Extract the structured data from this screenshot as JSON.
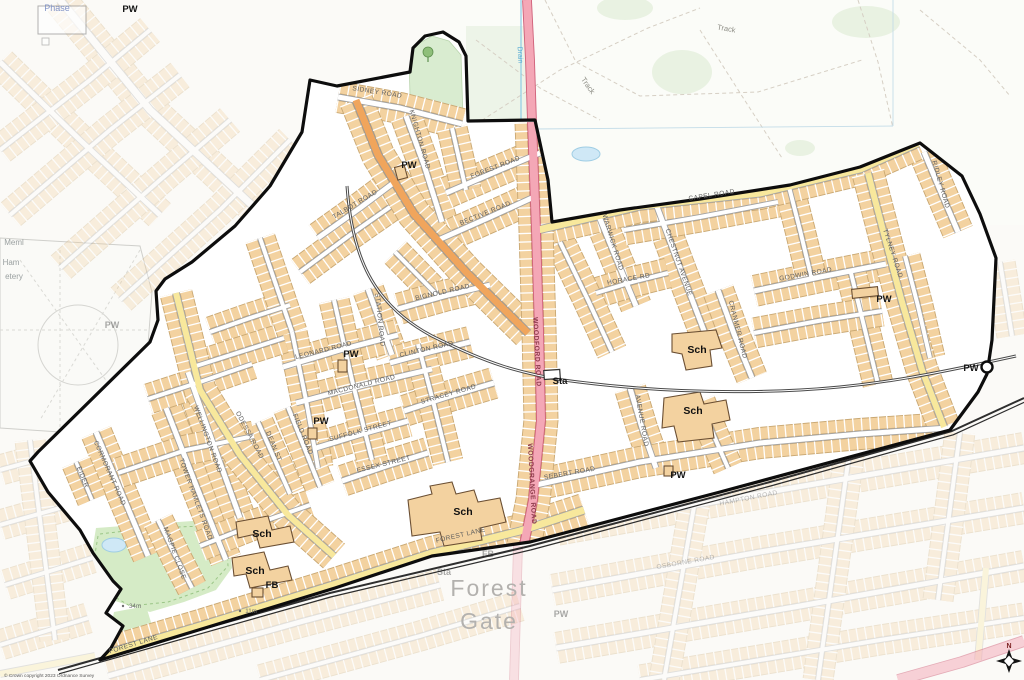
{
  "attribution": "© Crown copyright 2023 Ordnance Survey",
  "colors": {
    "building": "#f3d2a0",
    "road_yellow": "#f8e89c",
    "road_orange": "#f0a55c",
    "road_pink": "#f4a7b6",
    "boundary": "#0d0d0d",
    "park_green": "#d5ebc6",
    "water": "#cfe8f6",
    "railway": "#4a4a4a"
  },
  "labels": [
    {
      "t": "SIDNEY ROAD",
      "x": 377,
      "y": 94,
      "r": 9,
      "k": "rl"
    },
    {
      "t": "KNIGHTON ROAD",
      "x": 418,
      "y": 140,
      "r": 74,
      "k": "rl"
    },
    {
      "t": "TALBOT ROAD",
      "x": 356,
      "y": 206,
      "r": -31,
      "k": "rl"
    },
    {
      "t": "FOREST ROAD",
      "x": 496,
      "y": 169,
      "r": -21,
      "k": "rl"
    },
    {
      "t": "BECTIVE ROAD",
      "x": 486,
      "y": 215,
      "r": -22,
      "k": "rl"
    },
    {
      "t": "STATION ROAD",
      "x": 378,
      "y": 320,
      "r": 84,
      "k": "rl"
    },
    {
      "t": "BIGNOLD ROAD",
      "x": 443,
      "y": 294,
      "r": -13,
      "k": "rl"
    },
    {
      "t": "LEONARD ROAD",
      "x": 324,
      "y": 352,
      "r": -14,
      "k": "rl"
    },
    {
      "t": "CLINTON ROAD",
      "x": 427,
      "y": 351,
      "r": -13,
      "k": "rl"
    },
    {
      "t": "MACDONALD ROAD",
      "x": 362,
      "y": 387,
      "r": -14,
      "k": "rl"
    },
    {
      "t": "STRACEY ROAD",
      "x": 449,
      "y": 396,
      "r": -16,
      "k": "rl"
    },
    {
      "t": "SUFFOLK STREET",
      "x": 361,
      "y": 433,
      "r": -15,
      "k": "rl"
    },
    {
      "t": "ESSEX STREET",
      "x": 384,
      "y": 466,
      "r": -14,
      "k": "rl"
    },
    {
      "t": "ODESSA ROAD",
      "x": 248,
      "y": 436,
      "r": 62,
      "k": "rl"
    },
    {
      "t": "WELLINGTON ROAD",
      "x": 206,
      "y": 440,
      "r": 70,
      "k": "rl"
    },
    {
      "t": "TOWER HAMLETS ROAD",
      "x": 194,
      "y": 500,
      "r": 70,
      "k": "rl"
    },
    {
      "t": "CORMORANT ROAD",
      "x": 108,
      "y": 474,
      "r": 66,
      "k": "rl"
    },
    {
      "t": "MAGPIE CLOSE",
      "x": 173,
      "y": 554,
      "r": 70,
      "k": "rl"
    },
    {
      "t": "DEAN ST",
      "x": 272,
      "y": 447,
      "r": 68,
      "k": "rl"
    },
    {
      "t": "FIELD ROAD",
      "x": 301,
      "y": 435,
      "r": 68,
      "k": "rl"
    },
    {
      "t": "EIDER",
      "x": 81,
      "y": 478,
      "r": 68,
      "k": "rl"
    },
    {
      "t": "FOREST LANE",
      "x": 134,
      "y": 646,
      "r": -17,
      "k": "rl"
    },
    {
      "t": "FOREST LANE",
      "x": 461,
      "y": 537,
      "r": -13,
      "k": "rl"
    },
    {
      "t": "CAPEL ROAD",
      "x": 712,
      "y": 197,
      "r": -9,
      "k": "rl"
    },
    {
      "t": "WARWICK ROAD",
      "x": 611,
      "y": 243,
      "r": 73,
      "k": "rl"
    },
    {
      "t": "CHESTNUT AVENUE",
      "x": 677,
      "y": 263,
      "r": 71,
      "k": "rl"
    },
    {
      "t": "HORACE RD",
      "x": 629,
      "y": 281,
      "r": -10,
      "k": "rl"
    },
    {
      "t": "CRANMER ROAD",
      "x": 736,
      "y": 330,
      "r": 76,
      "k": "rl"
    },
    {
      "t": "GODWIN ROAD",
      "x": 806,
      "y": 276,
      "r": -10,
      "k": "rl"
    },
    {
      "t": "TYLNEY ROAD",
      "x": 891,
      "y": 254,
      "r": 72,
      "k": "rl"
    },
    {
      "t": "RIDLEY ROAD",
      "x": 939,
      "y": 185,
      "r": 74,
      "k": "rl"
    },
    {
      "t": "AVENUE ROAD",
      "x": 640,
      "y": 421,
      "r": 80,
      "k": "rl"
    },
    {
      "t": "SEBERT ROAD",
      "x": 570,
      "y": 475,
      "r": -10,
      "k": "rl"
    },
    {
      "t": "WOODFORD ROAD",
      "x": 535,
      "y": 352,
      "r": 87,
      "k": "rl-pink"
    },
    {
      "t": "WOODGRANGE ROAD",
      "x": 530,
      "y": 484,
      "r": 87,
      "k": "rl-pink"
    },
    {
      "t": "HAMPTON ROAD",
      "x": 749,
      "y": 500,
      "r": -11,
      "k": "faded-rl"
    },
    {
      "t": "OSBORNE ROAD",
      "x": 686,
      "y": 564,
      "r": -10,
      "k": "faded-rl"
    },
    {
      "t": "PW",
      "x": 409,
      "y": 168,
      "k": "poi"
    },
    {
      "t": "PW",
      "x": 351,
      "y": 357,
      "k": "poi"
    },
    {
      "t": "PW",
      "x": 321,
      "y": 424,
      "k": "poi"
    },
    {
      "t": "PW",
      "x": 884,
      "y": 302,
      "k": "poi"
    },
    {
      "t": "PW",
      "x": 678,
      "y": 478,
      "k": "poi"
    },
    {
      "t": "PW",
      "x": 971,
      "y": 371,
      "k": "poi"
    },
    {
      "t": "PW",
      "x": 130,
      "y": 12,
      "k": "poi"
    },
    {
      "t": "Sta",
      "x": 560,
      "y": 384,
      "k": "poi"
    },
    {
      "t": "FB",
      "x": 272,
      "y": 588,
      "k": "poi"
    },
    {
      "t": "Sch",
      "x": 697,
      "y": 353,
      "k": "sch"
    },
    {
      "t": "Sch",
      "x": 693,
      "y": 414,
      "k": "sch"
    },
    {
      "t": "Sch",
      "x": 463,
      "y": 515,
      "k": "sch"
    },
    {
      "t": "Sch",
      "x": 262,
      "y": 537,
      "k": "sch"
    },
    {
      "t": "Sch",
      "x": 255,
      "y": 574,
      "k": "sch"
    },
    {
      "t": "11m",
      "x": 251,
      "y": 613,
      "k": "spot"
    },
    {
      "t": "34m",
      "x": 135,
      "y": 608,
      "k": "spot"
    },
    {
      "t": "Forest",
      "x": 489,
      "y": 596,
      "k": "place"
    },
    {
      "t": "Gate",
      "x": 489,
      "y": 629,
      "k": "place"
    },
    {
      "t": "Track",
      "x": 586,
      "y": 87,
      "r": 55,
      "k": "track"
    },
    {
      "t": "Track",
      "x": 726,
      "y": 31,
      "r": 10,
      "k": "track"
    },
    {
      "t": "Drain",
      "x": 518,
      "y": 55,
      "r": 87,
      "k": "drain"
    },
    {
      "t": "Phase",
      "x": 57,
      "y": 11,
      "k": "phase"
    },
    {
      "t": "Meml",
      "x": 14,
      "y": 245,
      "k": "cem"
    },
    {
      "t": "Ham",
      "x": 11,
      "y": 265,
      "k": "cem"
    },
    {
      "t": "etery",
      "x": 14,
      "y": 279,
      "k": "cem"
    },
    {
      "t": "PW",
      "x": 112,
      "y": 328,
      "k": "faded-poi"
    },
    {
      "t": "Sta",
      "x": 444,
      "y": 575,
      "k": "faded-poi"
    },
    {
      "t": "PW",
      "x": 561,
      "y": 617,
      "k": "faded-poi"
    },
    {
      "t": "FB",
      "x": 488,
      "y": 557,
      "k": "faded-poi"
    },
    {
      "t": "N",
      "x": 1009,
      "y": 648,
      "k": "north"
    }
  ],
  "compass": {
    "north": "N"
  }
}
